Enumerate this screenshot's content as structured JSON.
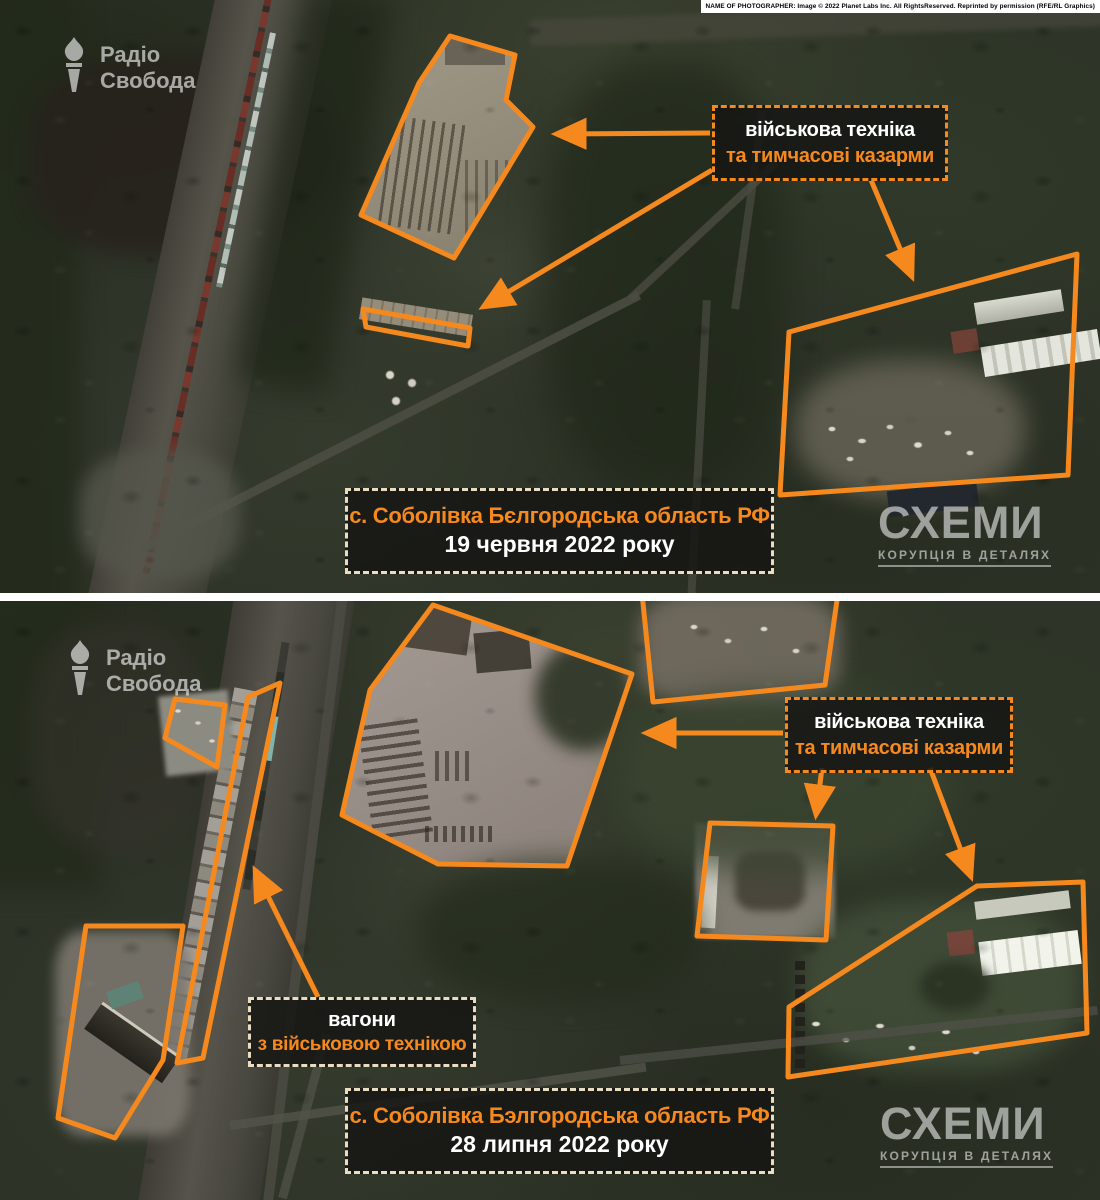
{
  "accent_color": "#f6891e",
  "callout_border_color": "#f6891e",
  "caption_border_color": "#e9dcc3",
  "credit": "NAME OF PHOTOGRAPHER: Image © 2022 Planet Labs Inc. All RightsReserved. Reprinted by permission (RFE/RL Graphics)",
  "brand": {
    "line1": "Радіо",
    "line2": "Свобода"
  },
  "watermark": {
    "title": "СХЕМИ",
    "subtitle": "КОРУПЦІЯ В ДЕТАЛЯХ"
  },
  "panel_top": {
    "label": {
      "line1": "військова техніка",
      "line2": "та тимчасові казарми"
    },
    "caption": {
      "line1": "с. Соболівка Бєлгородська область РФ",
      "line2": "19 червня 2022 року"
    }
  },
  "panel_bottom": {
    "label": {
      "line1": "військова техніка",
      "line2": "та тимчасові казарми"
    },
    "wagons_label": {
      "line1": "вагони",
      "line2": "з військовою технікою"
    },
    "caption": {
      "line1": "с. Соболівка Бэлгородська область РФ",
      "line2": "28 липня 2022 року"
    }
  }
}
